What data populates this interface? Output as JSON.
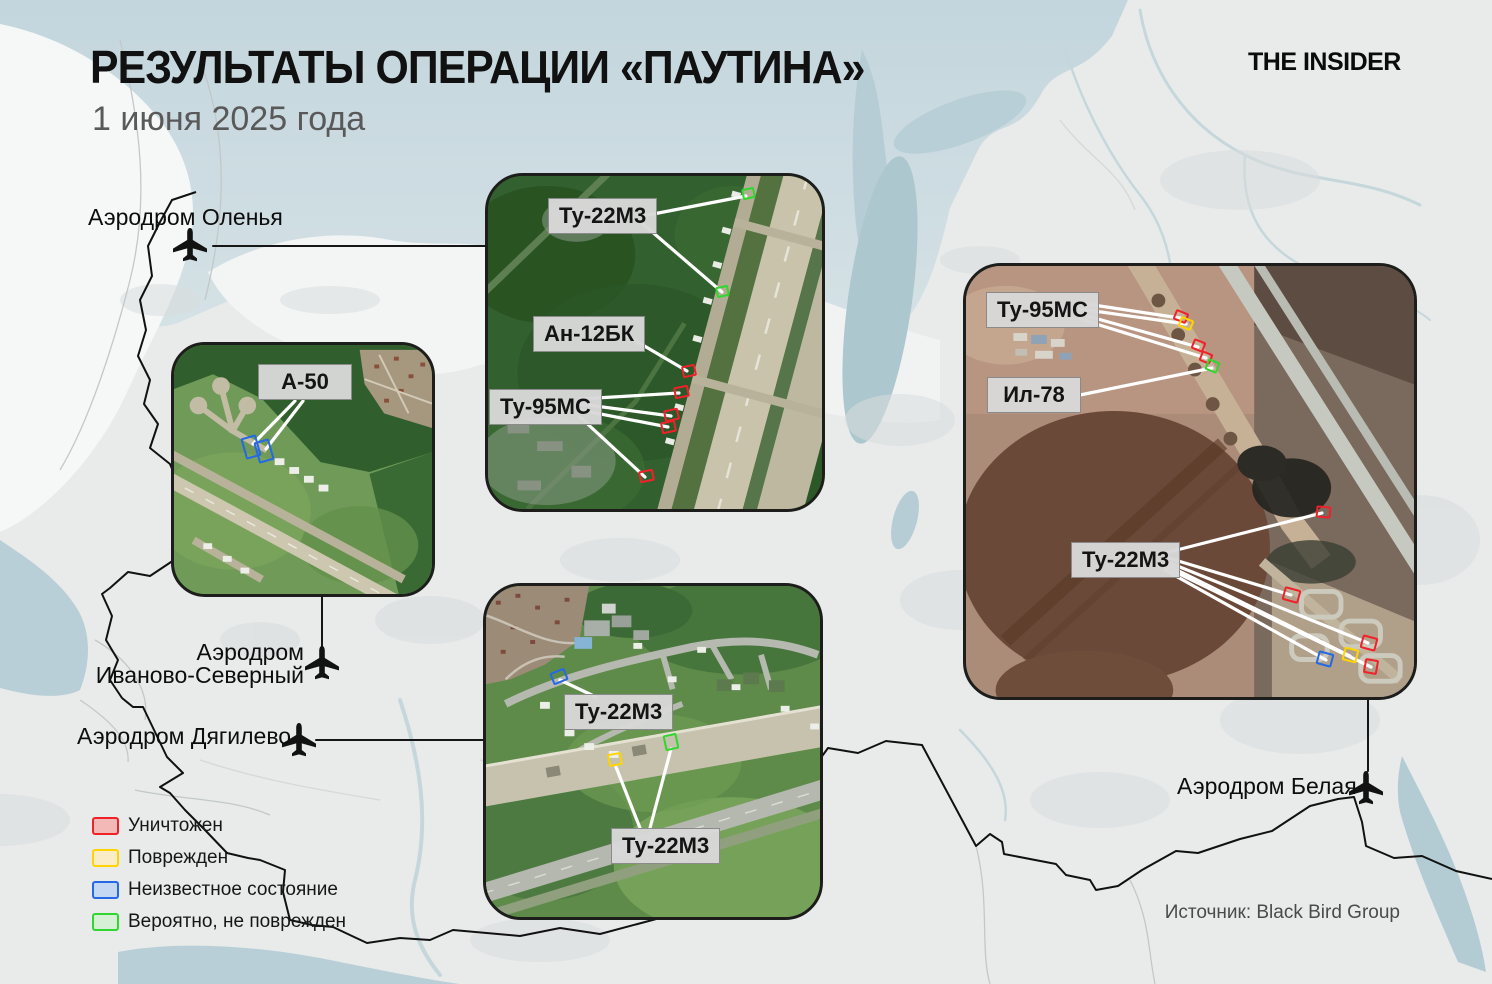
{
  "header": {
    "title": "РЕЗУЛЬТАТЫ ОПЕРАЦИИ «ПАУТИНА»",
    "subtitle": "1 июня 2025 года",
    "logo": "THE INSIDER"
  },
  "source": "Источник: Black Bird Group",
  "status_colors": {
    "destroyed": {
      "border": "#f1212a",
      "fill": "#f3b9b6",
      "label": "Уничтожен"
    },
    "damaged": {
      "border": "#ffd400",
      "fill": "#f9ecc7",
      "label": "Поврежден"
    },
    "unknown": {
      "border": "#2569e5",
      "fill": "#c5d8f3",
      "label": "Неизвестное состояние"
    },
    "probably_intact": {
      "border": "#2fd72f",
      "fill": "#d5f0d5",
      "label": "Вероятно, не поврежден"
    }
  },
  "airfields": {
    "olenya": {
      "label": "Аэродром Оленья"
    },
    "ivanovo": {
      "line1": "Аэродром",
      "line2": "Иваново-Северный"
    },
    "dyagilevo": {
      "label": "Аэродром Дягилево"
    },
    "belaya": {
      "label": "Аэродром Белая"
    }
  },
  "inset_labels": [
    {
      "id": "olenya-tu22m3",
      "text": "Ту-22М3",
      "x": 548,
      "y": 198
    },
    {
      "id": "olenya-an12bk",
      "text": "Ан-12БК",
      "x": 533,
      "y": 316
    },
    {
      "id": "olenya-tu95ms",
      "text": "Ту-95МС",
      "x": 489,
      "y": 389
    },
    {
      "id": "dyagilevo-tu22m3-upper",
      "text": "Ту-22М3",
      "x": 564,
      "y": 694
    },
    {
      "id": "dyagilevo-tu22m3-lower",
      "text": "Ту-22М3",
      "x": 611,
      "y": 828
    },
    {
      "id": "belaya-tu95ms",
      "text": "Ту-95МС",
      "x": 986,
      "y": 292
    },
    {
      "id": "belaya-il78",
      "text": "Ил-78",
      "x": 987,
      "y": 377
    },
    {
      "id": "belaya-tu22m3",
      "text": "Ту-22М3",
      "x": 1071,
      "y": 542
    },
    {
      "id": "ivanovo-a50",
      "text": "А-50",
      "x": 258,
      "y": 364
    }
  ],
  "strike_markers": [
    {
      "x": 742,
      "y": 188,
      "w": 13,
      "h": 11,
      "rot": -12,
      "status": "probably_intact"
    },
    {
      "x": 716,
      "y": 286,
      "w": 13,
      "h": 11,
      "rot": -12,
      "status": "probably_intact"
    },
    {
      "x": 682,
      "y": 365,
      "w": 14,
      "h": 12,
      "rot": -12,
      "status": "destroyed"
    },
    {
      "x": 674,
      "y": 386,
      "w": 15,
      "h": 12,
      "rot": -12,
      "status": "destroyed"
    },
    {
      "x": 664,
      "y": 409,
      "w": 15,
      "h": 12,
      "rot": -12,
      "status": "destroyed"
    },
    {
      "x": 661,
      "y": 421,
      "w": 15,
      "h": 12,
      "rot": -12,
      "status": "destroyed"
    },
    {
      "x": 639,
      "y": 470,
      "w": 15,
      "h": 12,
      "rot": -12,
      "status": "destroyed"
    },
    {
      "x": 551,
      "y": 670,
      "w": 16,
      "h": 13,
      "rot": -22,
      "status": "unknown"
    },
    {
      "x": 608,
      "y": 753,
      "w": 14,
      "h": 13,
      "rot": -10,
      "status": "damaged"
    },
    {
      "x": 664,
      "y": 734,
      "w": 14,
      "h": 16,
      "rot": -12,
      "status": "probably_intact"
    },
    {
      "x": 243,
      "y": 436,
      "w": 16,
      "h": 22,
      "rot": -16,
      "status": "unknown"
    },
    {
      "x": 256,
      "y": 440,
      "w": 16,
      "h": 22,
      "rot": -16,
      "status": "unknown"
    },
    {
      "x": 1174,
      "y": 311,
      "w": 14,
      "h": 11,
      "rot": 22,
      "status": "destroyed"
    },
    {
      "x": 1179,
      "y": 318,
      "w": 14,
      "h": 11,
      "rot": 22,
      "status": "damaged"
    },
    {
      "x": 1192,
      "y": 340,
      "w": 13,
      "h": 11,
      "rot": 22,
      "status": "destroyed"
    },
    {
      "x": 1200,
      "y": 352,
      "w": 12,
      "h": 11,
      "rot": 22,
      "status": "destroyed"
    },
    {
      "x": 1206,
      "y": 360,
      "w": 13,
      "h": 12,
      "rot": 22,
      "status": "probably_intact"
    },
    {
      "x": 1316,
      "y": 506,
      "w": 15,
      "h": 12,
      "rot": 5,
      "status": "destroyed"
    },
    {
      "x": 1283,
      "y": 588,
      "w": 17,
      "h": 14,
      "rot": 15,
      "status": "destroyed"
    },
    {
      "x": 1361,
      "y": 636,
      "w": 16,
      "h": 14,
      "rot": 15,
      "status": "destroyed"
    },
    {
      "x": 1343,
      "y": 648,
      "w": 15,
      "h": 14,
      "rot": 15,
      "status": "damaged"
    },
    {
      "x": 1364,
      "y": 659,
      "w": 14,
      "h": 15,
      "rot": 10,
      "status": "destroyed"
    },
    {
      "x": 1317,
      "y": 652,
      "w": 16,
      "h": 14,
      "rot": 15,
      "status": "unknown"
    }
  ],
  "leader_lines_white": [
    [
      643,
      216,
      746,
      196
    ],
    [
      643,
      224,
      722,
      292
    ],
    [
      624,
      334,
      687,
      371
    ],
    [
      580,
      399,
      679,
      393
    ],
    [
      580,
      404,
      671,
      416
    ],
    [
      580,
      410,
      668,
      427
    ],
    [
      580,
      417,
      645,
      477
    ],
    [
      560,
      680,
      596,
      697
    ],
    [
      640,
      828,
      616,
      767
    ],
    [
      650,
      828,
      671,
      749
    ],
    [
      1080,
      303,
      1180,
      318
    ],
    [
      1080,
      309,
      1186,
      324
    ],
    [
      1080,
      314,
      1198,
      347
    ],
    [
      1080,
      319,
      1206,
      358
    ],
    [
      1080,
      395,
      1212,
      368
    ],
    [
      1165,
      553,
      1322,
      513
    ],
    [
      1165,
      557,
      1291,
      595
    ],
    [
      1165,
      561,
      1368,
      643
    ],
    [
      1165,
      564,
      1350,
      656
    ],
    [
      1165,
      567,
      1371,
      667
    ],
    [
      1165,
      570,
      1326,
      660
    ],
    [
      295,
      401,
      253,
      444
    ],
    [
      303,
      401,
      266,
      449
    ]
  ],
  "map_connector_lines": [
    [
      213,
      246,
      485,
      246
    ],
    [
      322,
      597,
      322,
      647
    ],
    [
      316,
      740,
      483,
      740
    ],
    [
      1368,
      700,
      1368,
      771
    ]
  ]
}
